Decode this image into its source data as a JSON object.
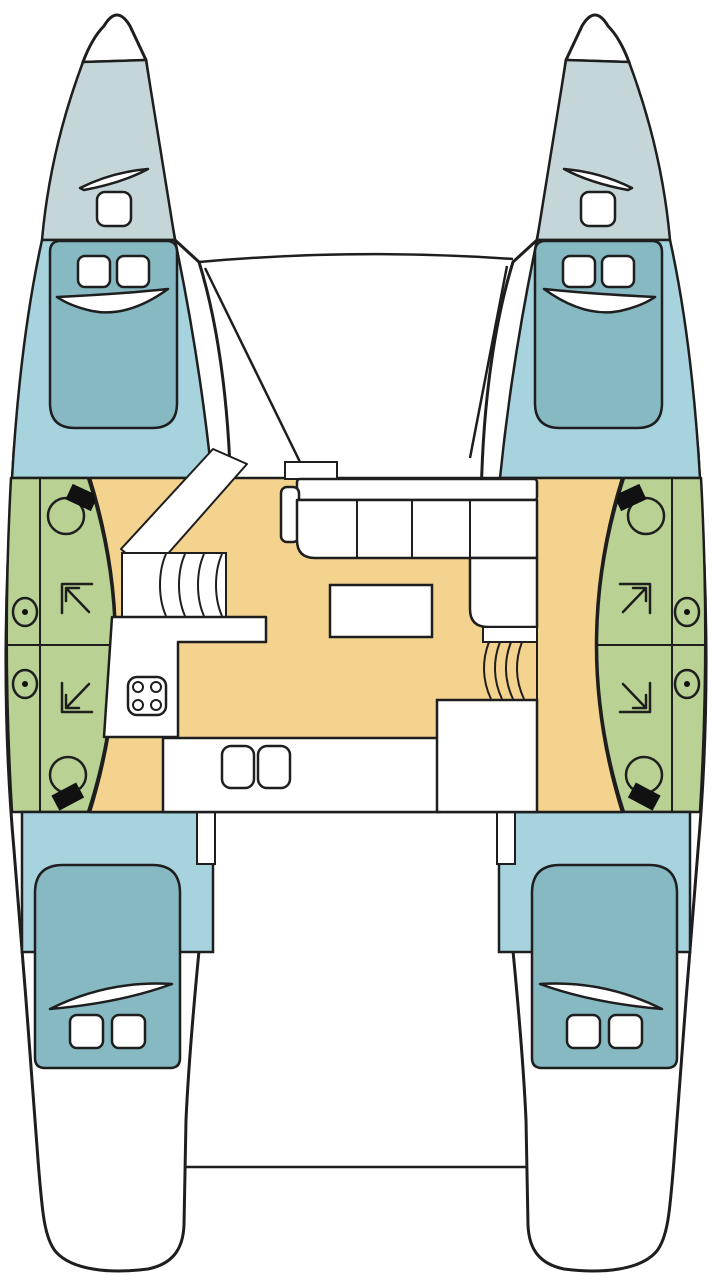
{
  "diagram": {
    "type": "catamaran-deck-plan",
    "hull_count": "2",
    "cabin_count": "4",
    "bathroom_count": "4",
    "rooms": [
      {
        "id": "forepeak-port",
        "label": "port forepeak locker"
      },
      {
        "id": "forepeak-starboard",
        "label": "starboard forepeak locker"
      },
      {
        "id": "cabin-forward-port",
        "label": "forward port double cabin"
      },
      {
        "id": "cabin-forward-starboard",
        "label": "forward starboard double cabin"
      },
      {
        "id": "bathroom-port",
        "label": "port heads with shower, sinks, two toilets"
      },
      {
        "id": "bathroom-starboard",
        "label": "starboard heads with shower, sinks, two toilets"
      },
      {
        "id": "saloon",
        "label": "central saloon with L-sofa, table and galley"
      },
      {
        "id": "cabin-aft-port",
        "label": "aft port double cabin"
      },
      {
        "id": "cabin-aft-starboard",
        "label": "aft starboard double cabin"
      },
      {
        "id": "cockpit",
        "label": "aft cockpit deck"
      }
    ],
    "features": [
      "l-shaped-sofa",
      "saloon-table",
      "four-burner-stove",
      "double-sink",
      "hull-stairs",
      "bow-hatches"
    ]
  },
  "colors": {
    "outline": "#1e1e1e",
    "white": "#ffffff",
    "forepeak": "#c5d6d8",
    "cabin": "#a6d3de",
    "bed": "#87b9c2",
    "bathroom": "#b9d293",
    "floor": "#f4d38f",
    "fixture_black": "#111111"
  }
}
